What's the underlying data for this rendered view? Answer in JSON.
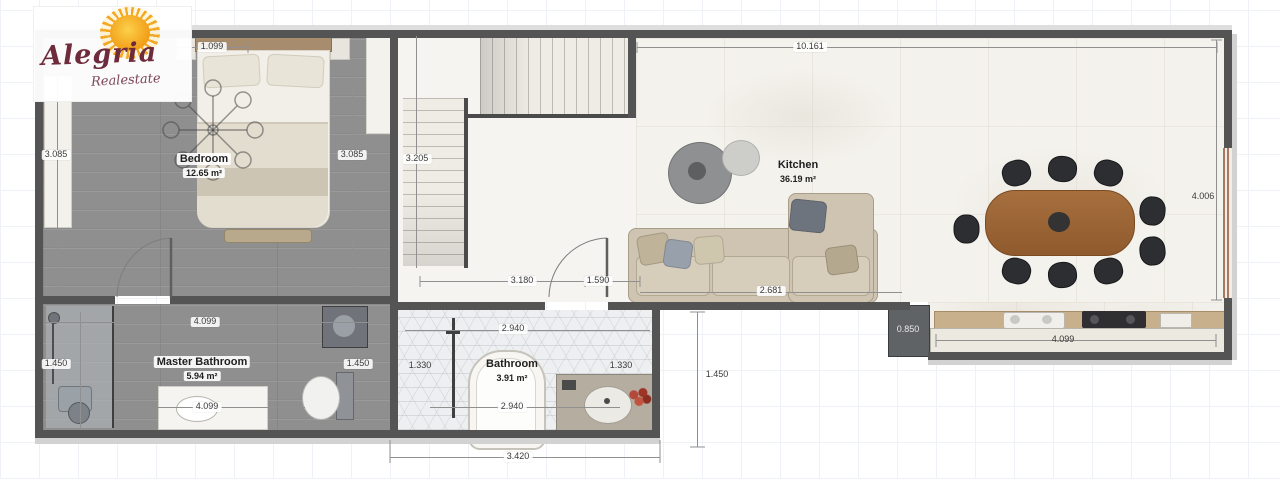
{
  "logo": {
    "name": "Alegria",
    "subtitle": "Realestate"
  },
  "colors": {
    "wall": "#545454",
    "logo_text": "#6e2b3b",
    "sun": "#f2a417",
    "wood_floor": "#8f8f8f"
  },
  "rooms": {
    "bedroom": {
      "label": "Bedroom",
      "area": "12.65 m²"
    },
    "kitchen": {
      "label": "Kitchen",
      "area": "36.19 m²"
    },
    "master_bathroom": {
      "label": "Master Bathroom",
      "area": "5.94 m²"
    },
    "bathroom": {
      "label": "Bathroom",
      "area": "3.91 m²"
    }
  },
  "dimensions": {
    "bed_width": "1.099",
    "kitchen_top": "10.161",
    "bedroom_left_height": "3.085",
    "bedroom_right_height": "3.085",
    "stair_height": "3.205",
    "right_height": "4.006",
    "hall_bottom": "3.180",
    "kitchen_door": "1.590",
    "sofa_width": "2.681",
    "master_bath_top": "4.099",
    "master_bath_bottom": "4.099",
    "master_bath_left": "1.450",
    "master_bath_right": "1.450",
    "bathroom_left": "1.330",
    "bathroom_top": "2.940",
    "bathroom_bottom": "2.940",
    "bathroom_right": "1.330",
    "appliance_depth": "0.850",
    "counter_width": "4.099",
    "outside_right_height": "1.450",
    "bottom_width": "3.420"
  }
}
